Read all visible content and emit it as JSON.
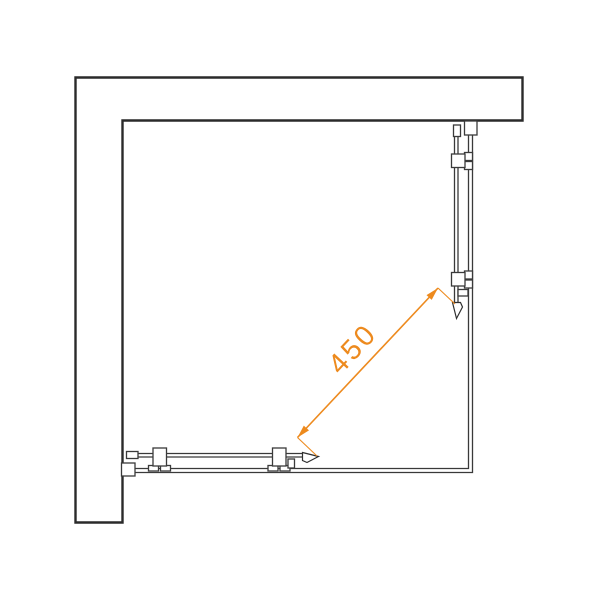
{
  "diagram": {
    "title": "shower-enclosure-plan-view",
    "dimension": {
      "label": "450"
    },
    "colors": {
      "accent": "#ED8A1E",
      "line": "#2A2A2A",
      "background": "#FFFFFF"
    }
  }
}
